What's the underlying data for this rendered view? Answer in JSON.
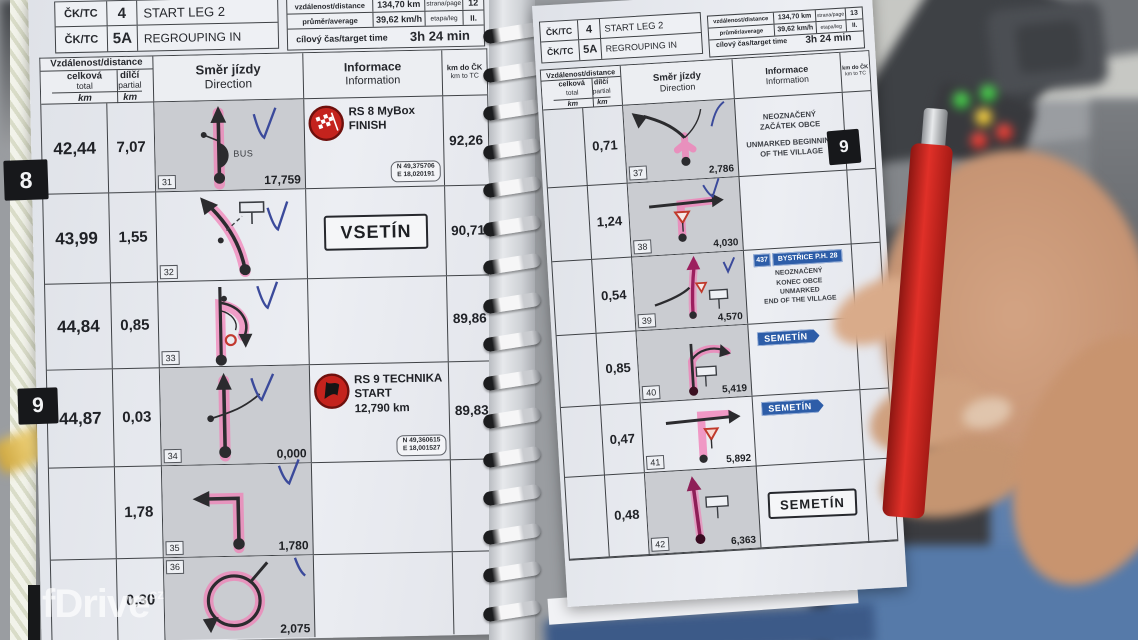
{
  "colors": {
    "pink_highlight": "#f27cb5",
    "pen_blue": "#3b4a9b",
    "stage_red": "#c4231d",
    "sign_blue": "#2d5da8",
    "paper": "#eceef3"
  },
  "watermark": {
    "name": "fDrive",
    "tld": "cz"
  },
  "book": {
    "header": {
      "tc_label": "ČK/TC",
      "tc1_num": "4",
      "tc1_title": "START LEG 2",
      "tc2_num": "5A",
      "tc2_title": "REGROUPING IN",
      "distance_label": "vzdálenost/distance",
      "distance_value": "134,70 km",
      "average_label": "průměr/average",
      "average_value": "39,62 km/h",
      "page_label": "strana/page",
      "leg_label": "etapa/leg",
      "leg_value": "II.",
      "target_label": "cílový čas/target time",
      "target_value": "3h 24 min"
    },
    "left_page_num": "12",
    "right_page_num": "13",
    "columns": {
      "distance_group": "Vzdálenost/distance",
      "total_label": "celková",
      "total_sub": "total",
      "partial_label": "dílčí",
      "partial_sub": "partial",
      "unit": "km",
      "direction_label": "Směr jízdy",
      "direction_sub": "Direction",
      "info_label": "Informace",
      "info_sub": "Information",
      "kmtc_label": "km do ČK",
      "kmtc_sub": "km to TC"
    },
    "tabs": {
      "left_8": "8",
      "left_9": "9",
      "right_9": "9"
    },
    "left_rows": [
      {
        "box": "31",
        "total": "42,44",
        "partial": "7,07",
        "note": "BUS",
        "tulip_dist": "17,759",
        "rs_title": "RS 8 MyBox",
        "rs_sub": "FINISH",
        "gps_n": "N 49,375706",
        "gps_e": "E 18,020191",
        "km_tc": "92,26"
      },
      {
        "box": "32",
        "total": "43,99",
        "partial": "1,55",
        "city_sign": "VSETÍN",
        "km_tc": "90,71"
      },
      {
        "box": "33",
        "total": "44,84",
        "partial": "0,85",
        "km_tc": "89,86"
      },
      {
        "box": "34",
        "total": "44,87",
        "partial": "0,03",
        "tulip_dist": "0,000",
        "rs_title": "RS 9 TECHNIKA",
        "rs_sub": "START",
        "rs_dist": "12,790 km",
        "gps_n": "N 49,360615",
        "gps_e": "E 18,001527",
        "km_tc": "89,83"
      },
      {
        "box": "35",
        "partial": "1,78",
        "tulip_dist": "1,780"
      },
      {
        "box": "36",
        "partial": "0,30",
        "tulip_dist": "2,075"
      }
    ],
    "right_rows": [
      {
        "box": "37",
        "partial": "0,71",
        "tulip_dist": "2,786",
        "cz1": "NEOZNAČENÝ",
        "cz2": "ZAČÁTEK OBCE",
        "en1": "UNMARKED BEGINNING",
        "en2": "OF THE VILLAGE"
      },
      {
        "box": "38",
        "partial": "1,24",
        "tulip_dist": "4,030"
      },
      {
        "box": "39",
        "partial": "0,54",
        "tulip_dist": "4,570",
        "road_num": "437",
        "road_name": "BYSTŘICE P.H. 28",
        "cz1": "NEOZNAČENÝ",
        "cz2": "KONEC OBCE",
        "en1": "UNMARKED",
        "en2": "END OF THE VILLAGE"
      },
      {
        "box": "40",
        "partial": "0,85",
        "tulip_dist": "5,419",
        "dir_sign": "SEMETÍN"
      },
      {
        "box": "41",
        "partial": "0,47",
        "tulip_dist": "5,892",
        "dir_sign": "SEMETÍN"
      },
      {
        "box": "42",
        "partial": "0,48",
        "tulip_dist": "6,363",
        "city_box": "SEMETÍN"
      }
    ]
  }
}
